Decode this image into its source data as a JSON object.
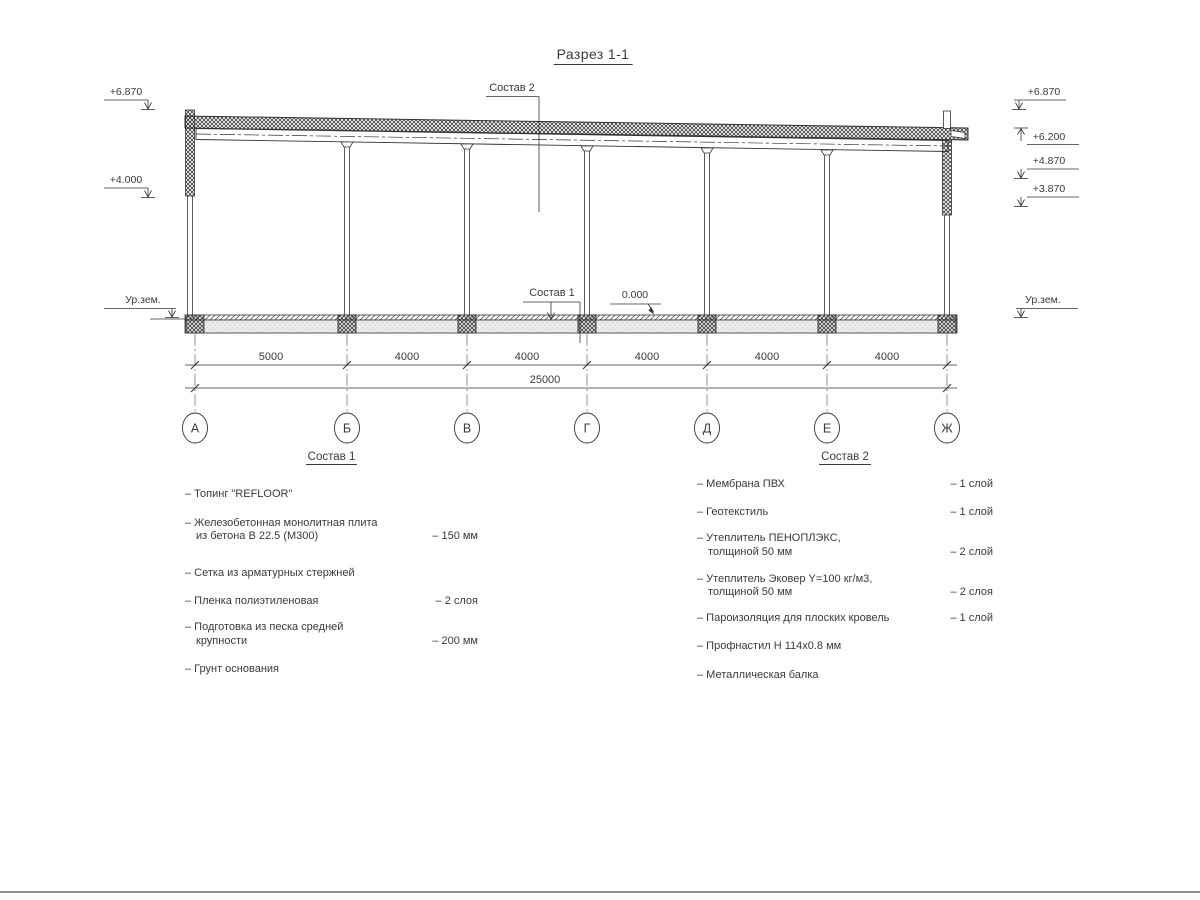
{
  "title": "Разрез 1-1",
  "drawing": {
    "levels_left": {
      "l1": "+6.870",
      "l2": "+4.000",
      "ground": "Ур.зем."
    },
    "levels_right": {
      "l1": "+6.870",
      "l2": "+6.200",
      "l3": "+4.870",
      "l4": "+3.870",
      "ground": "Ур.зем."
    },
    "zero": "0.000",
    "leaders": {
      "roof": "Состав 2",
      "floor": "Состав 1"
    },
    "dims": {
      "segments": [
        "5000",
        "4000",
        "4000",
        "4000",
        "4000",
        "4000"
      ],
      "total": "25000"
    },
    "axes": [
      "А",
      "Б",
      "В",
      "Г",
      "Д",
      "Е",
      "Ж"
    ]
  },
  "sostav1": {
    "title": "Состав 1",
    "items": [
      {
        "name": "– Топинг \"REFLOOR\"",
        "value": ""
      },
      {
        "name": "– Железобетонная  монолитная плита\nиз бетона В 22.5 (М300)",
        "value": "– 150 мм"
      },
      {
        "name": "– Сетка из арматурных стержней",
        "value": ""
      },
      {
        "name": "– Пленка полиэтиленовая",
        "value": "– 2 слоя"
      },
      {
        "name": "– Подготовка из песка средней\nкрупности",
        "value": "– 200 мм"
      },
      {
        "name": "– Грунт основания",
        "value": ""
      }
    ]
  },
  "sostav2": {
    "title": "Состав 2",
    "items": [
      {
        "name": "– Мембрана ПВХ",
        "value": "– 1 слой"
      },
      {
        "name": "– Геотекстиль",
        "value": "– 1 слой"
      },
      {
        "name": "– Утеплитель ПЕНОПЛЭКС,\nтолщиной 50 мм",
        "value": "– 2 слой"
      },
      {
        "name": "– Утеплитель Эковер Y=100 кг/м3,\nтолщиной 50 мм",
        "value": "– 2 слоя"
      },
      {
        "name": "– Пароизоляция для плоских кровель",
        "value": "– 1 слой"
      },
      {
        "name": "– Профнастил Н 114х0.8 мм",
        "value": ""
      },
      {
        "name": "– Металлическая балка",
        "value": ""
      }
    ]
  }
}
